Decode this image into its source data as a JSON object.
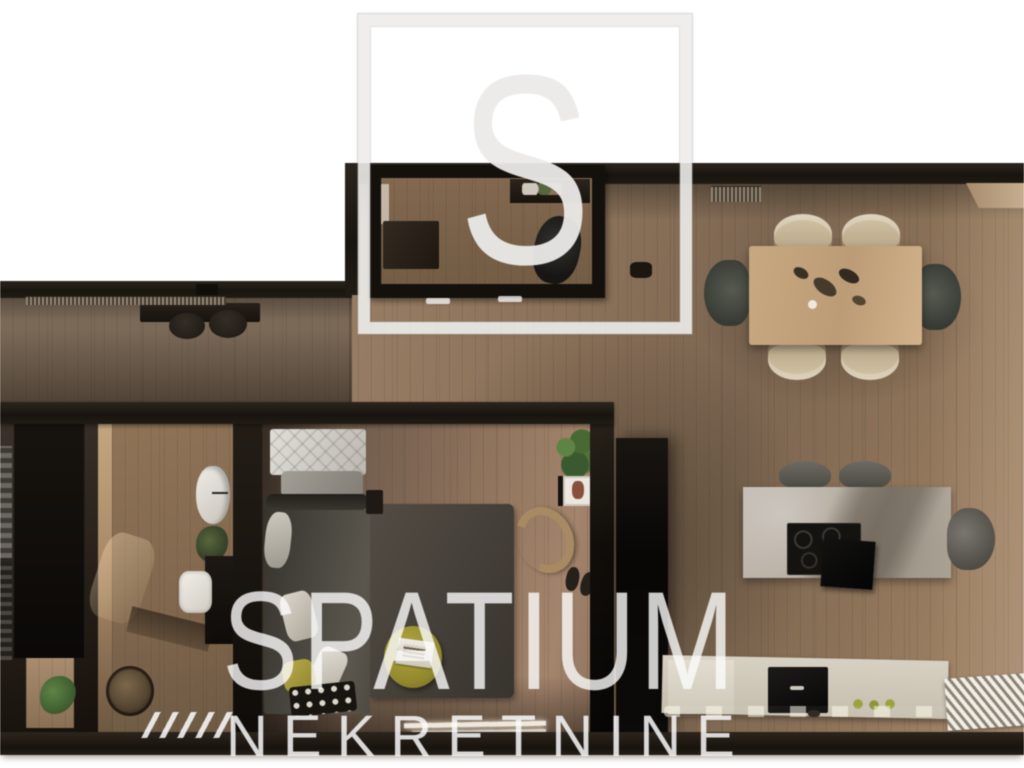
{
  "watermark": {
    "logo_letter": "S",
    "brand": "SPATIUM",
    "subtitle": "NEKRETNINE"
  },
  "palette": {
    "background": "#ffffff",
    "wall_dark": "#1d1813",
    "floor_living": "#8d7258",
    "floor_left_wing": "#74604e",
    "floor_bedroom": "#94785e",
    "floor_bathroom": "#8a6e52",
    "floor_office": "#7a624a",
    "dining_table": "#c4a47d",
    "dining_chair_beige": "#cbb795",
    "dining_chair_dark": "#474a42",
    "island_stone": "#b6ada0",
    "counter_stone": "#cfc8b9",
    "bar_stool": "#55524c",
    "bed_cover": "#4a463f",
    "headboard": "#d5d2cb",
    "area_rug": "#49423c",
    "pouf_yellow": "#a89b35",
    "plant_green": "#4a6b39",
    "watermark_white": "rgba(255,255,255,0.8)"
  }
}
